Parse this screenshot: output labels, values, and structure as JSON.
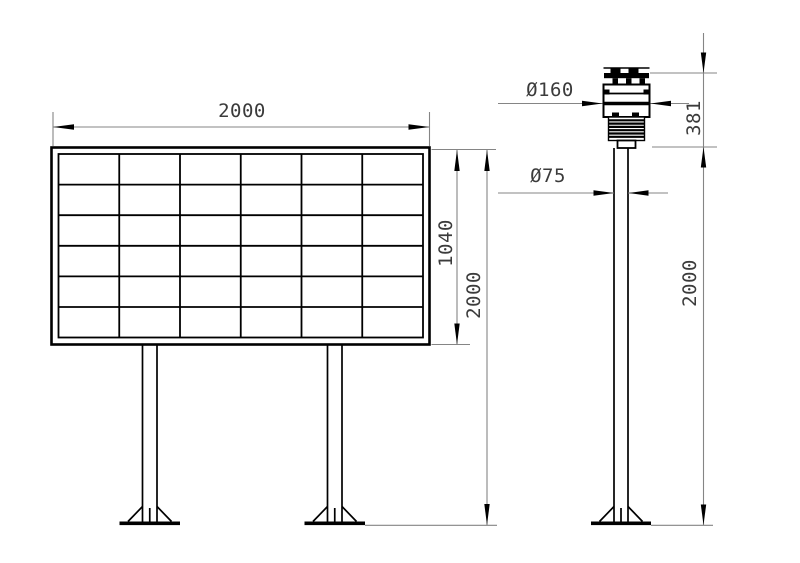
{
  "board": {
    "width_label": "2000",
    "panel_height_label": "1040",
    "total_height_label": "2000",
    "grid_rows": 6,
    "grid_cols": 6
  },
  "pole": {
    "sensor_diameter_label": "Ø160",
    "sensor_height_label": "381",
    "pole_diameter_label": "Ø75",
    "pole_height_label": "2000"
  },
  "colors": {
    "object_line": "#000000",
    "dimension_line": "#858585",
    "label_text": "#3b3b3b",
    "background": "#ffffff"
  }
}
